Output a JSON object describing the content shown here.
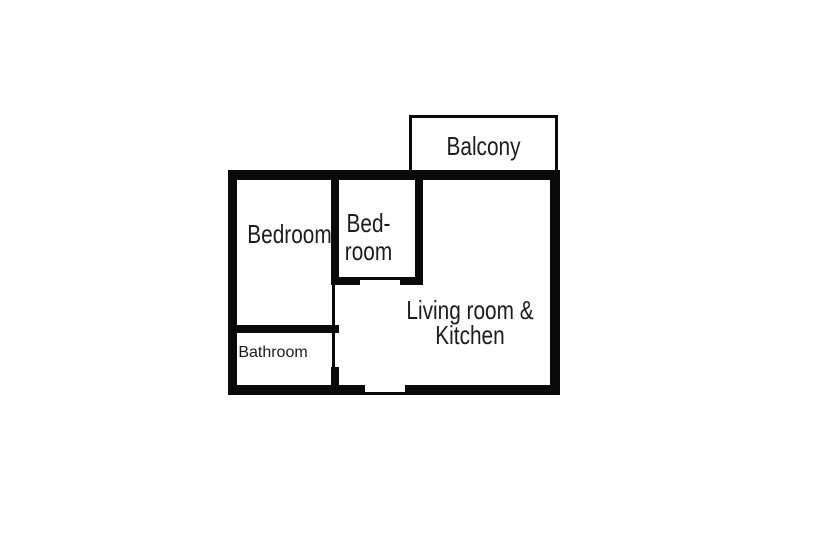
{
  "colors": {
    "bg": "#ffffff",
    "wall": "#0a0a0a",
    "text": "#1c1c1c"
  },
  "rooms": {
    "balcony": {
      "label": "Balcony"
    },
    "bedroom": {
      "label": "Bedroom"
    },
    "small_bedroom": {
      "line1": "Bed-",
      "line2": "room"
    },
    "living_kitchen": {
      "line1": "Living room &",
      "line2": "Kitchen"
    },
    "bathroom": {
      "label": "Bathroom"
    }
  }
}
